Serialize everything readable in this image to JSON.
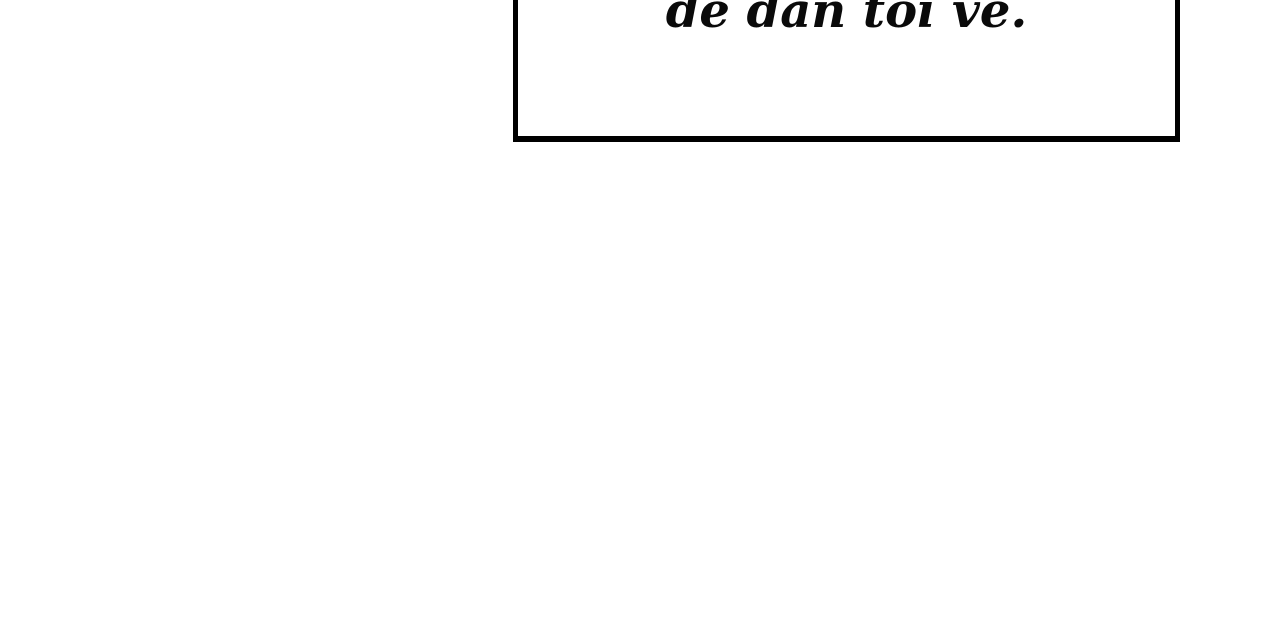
{
  "page": {
    "background_color": "#ffffff"
  },
  "caption_box": {
    "text": "để dẫn tôi về.",
    "border_color": "#000000",
    "fill_color": "#ffffff",
    "text_color": "#0a0a0a"
  }
}
